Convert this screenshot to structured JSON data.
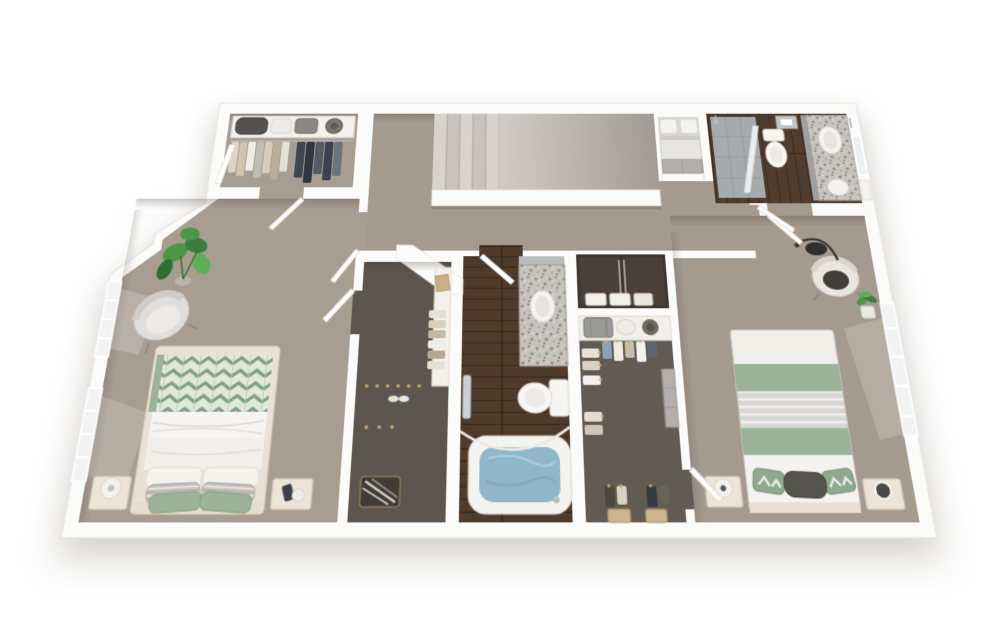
{
  "meta": {
    "description": "3D rendered top-view floor plan of a two-bedroom, two-bath upper floor with walk-in closets, laundry closet and staircase",
    "render_style": "white-walled dollhouse 3D render on white background"
  },
  "palette": {
    "bg": "#ffffff",
    "wall": "#fbfbfa",
    "wallEdge": "#e3e0db",
    "carpet": "#a89d91",
    "carpet2": "#a59a8e",
    "closetCarpet": "#5d564e",
    "closetCarpet2": "#625b52",
    "wood": "#4e3b2b",
    "woodLine": "#382a1e",
    "granite": "#c6c2bc",
    "water": "#8fb7c9",
    "waterSwirl": "#b7d2de",
    "sage": "#9cb39a",
    "sageDeep": "#7fa07e",
    "paleSage": "#e0e8da",
    "cream": "#e9e2d4",
    "white": "#f6f5f2",
    "grayFabric": "#d8d7d3",
    "darkCushion": "#3f3e3b",
    "plant": "#4c9648",
    "plantDark": "#3a7d3c",
    "tanBasket": "#cdb68f",
    "navy": "#3e4654",
    "charcoal": "#2f3642",
    "chrome": "#b9bcbf",
    "tile": "#a7abad",
    "slopeLight": "#d2ccc4",
    "slopeDark": "#a49c92",
    "tread": "#d8d3cc",
    "treadAlt": "#c8c2ba"
  },
  "scene": {
    "rooms": [
      {
        "id": "bedroom-1",
        "floor": "carpet",
        "furniture": [
          "bed-chevron-green-blanket",
          "white-sheets",
          "white-pillows",
          "striped-pillows",
          "sage-pillows",
          "nightstand-with-lamp",
          "nightstand-with-phone",
          "gray-armchair",
          "monstera-plant",
          "window-west-1",
          "window-west-2"
        ]
      },
      {
        "id": "closet-1",
        "floor": "carpet",
        "contents": [
          "shelf-with-duffel-and-bags",
          "hat",
          "hanging-clothes-light",
          "hanging-clothes-dark",
          "open-door"
        ]
      },
      {
        "id": "hall-and-stairs",
        "floor": "carpet",
        "contents": [
          "stair-landing",
          "stair-treads",
          "stair-slope",
          "railing-half-wall"
        ]
      },
      {
        "id": "bedroom-1-closet",
        "floor": "dark-carpet",
        "contents": [
          "side-shelf",
          "tan-box",
          "hanging-clothes",
          "shoes",
          "basket-with-striped-blanket"
        ]
      },
      {
        "id": "bathroom-1",
        "floor": "dark-wood",
        "contents": [
          "granite-vanity",
          "oval-sink",
          "mirror-panel",
          "toilet",
          "bathtub-with-water",
          "curved-shower-rod",
          "towel-on-bar"
        ]
      },
      {
        "id": "linen-closet",
        "contents": [
          "dark-double-doors",
          "towel-stacks"
        ]
      },
      {
        "id": "walk-in-closet-2",
        "floor": "dark-carpet",
        "contents": [
          "top-shelf",
          "suitcase",
          "hat-box",
          "hat",
          "hanging-clothes-north",
          "hanging-clothes-west",
          "hanging-clothes-south",
          "two-tan-baskets",
          "open-door"
        ]
      },
      {
        "id": "laundry-closet",
        "contents": [
          "stacked-washer-dryer"
        ]
      },
      {
        "id": "bathroom-2",
        "floor": "dark-wood",
        "contents": [
          "glass-shower",
          "shower-head",
          "toilet",
          "granite-vanity",
          "oval-sink",
          "leaning-mirror",
          "towel-bars",
          "ceiling-vent",
          "open-door"
        ]
      },
      {
        "id": "bedroom-2",
        "floor": "carpet",
        "furniture": [
          "bed-sage-and-gray-stripes",
          "patterned-pillows",
          "dark-lumbar-pillow",
          "nightstand-white-lamp",
          "nightstand-black-lamp",
          "barrel-chair-dark-cushion",
          "arc-floor-lamp",
          "potted-plant",
          "window-east",
          "entry-door",
          "bath-door"
        ]
      }
    ]
  }
}
